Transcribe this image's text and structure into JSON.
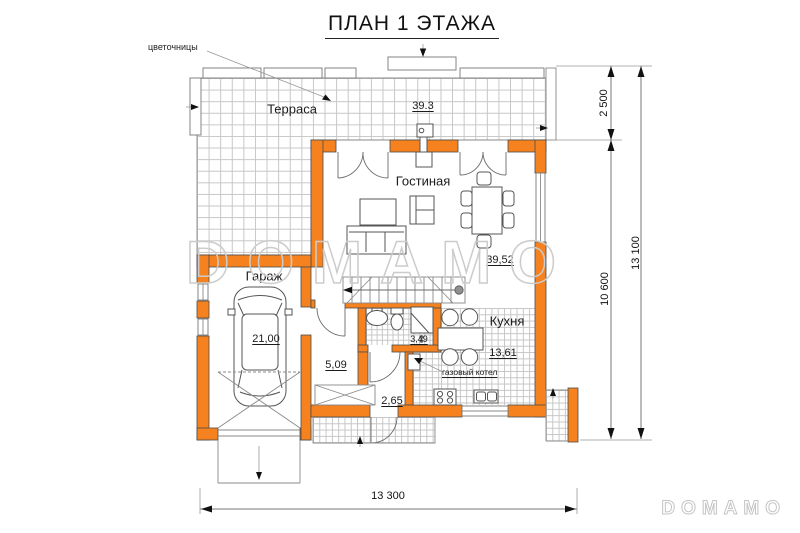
{
  "title": "ПЛАН 1 ЭТАЖА",
  "callouts": {
    "flower_boxes": "цветочницы",
    "gas_boiler": "газовый котел"
  },
  "rooms": {
    "terrace": {
      "name": "Терраса",
      "area": "39.3"
    },
    "living_room": {
      "name": "Гостиная",
      "area": "39,52"
    },
    "garage": {
      "name": "Гараж",
      "area": "21,00"
    },
    "kitchen": {
      "name": "Кухня",
      "area": "13,61"
    },
    "hallway": {
      "area": "5,09"
    },
    "entry": {
      "area": "2,65"
    },
    "bathroom": {
      "area": "3,49"
    }
  },
  "dimensions": {
    "terrace_depth": "2 500",
    "house_depth": "10 600",
    "total_height": "13 100",
    "total_width": "13 300"
  },
  "watermark": {
    "center": "DOMAMO",
    "corner": "DOMAMO"
  },
  "colors": {
    "wall": "#F5821F",
    "tile_line": "#c6c6c6",
    "outline": "#4b4b4b",
    "dimension_line": "#777777",
    "watermark": "#cccccc"
  }
}
